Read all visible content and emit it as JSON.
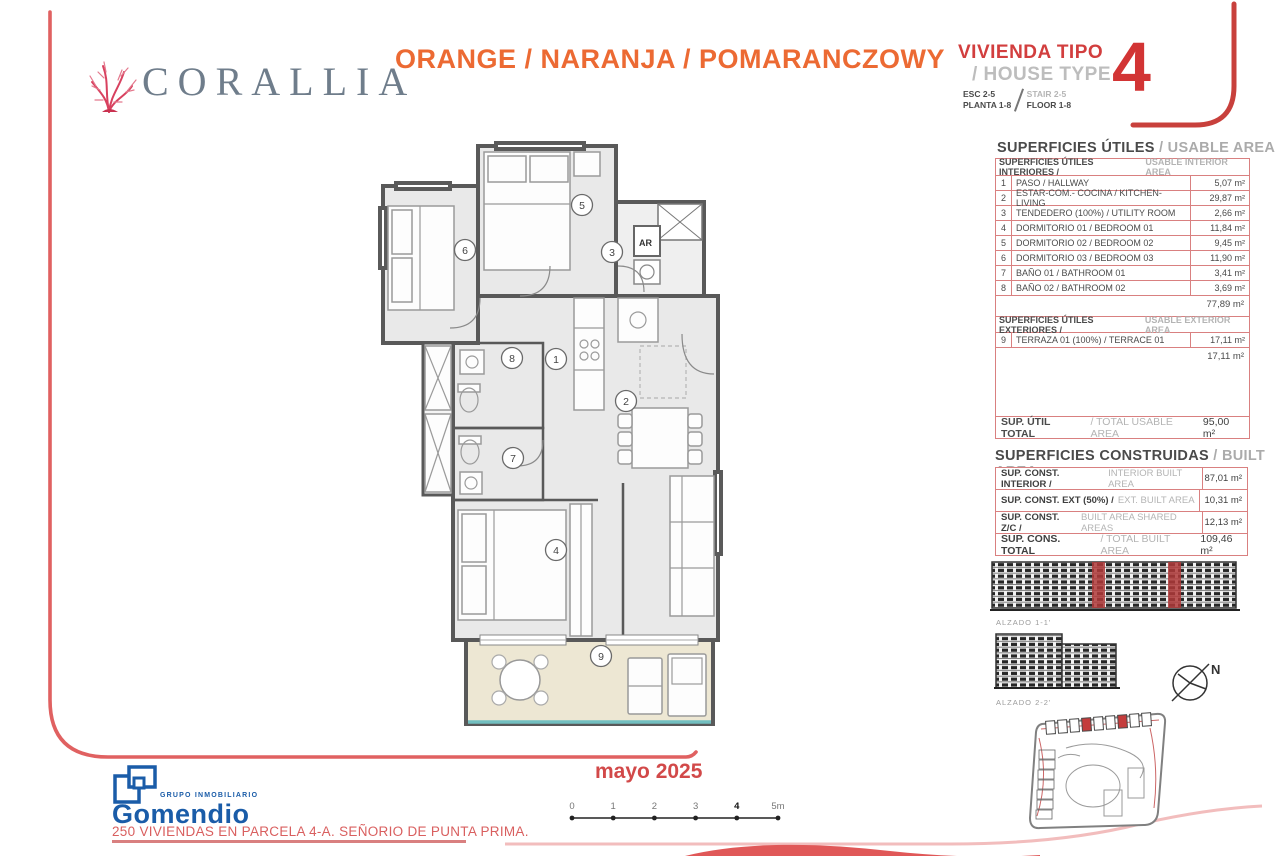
{
  "brand": {
    "name": "CORALLIA"
  },
  "header": {
    "color_title": "ORANGE / NARANJA / POMARANCZOWY"
  },
  "house_type": {
    "title_es": "VIVIENDA TIPO",
    "title_en": "/ HOUSE TYPE",
    "number": "4",
    "esc": "ESC 2-5",
    "planta": "PLANTA 1-8",
    "stair": "STAIR 2-5",
    "floor": "FLOOR 1-8"
  },
  "usable_area": {
    "title_es": "SUPERFICIES ÚTILES",
    "title_en": "/ USABLE AREA",
    "interior_header_es": "SUPERFICIES ÚTILES INTERIORES /",
    "interior_header_en": "USABLE INTERIOR AREA",
    "interior_rows": [
      {
        "num": "1",
        "label": "PASO / HALLWAY",
        "value": "5,07 m²"
      },
      {
        "num": "2",
        "label": "ESTAR-COM.- COCINA / KITCHEN-LIVING",
        "value": "29,87 m²"
      },
      {
        "num": "3",
        "label": "TENDEDERO (100%) / UTILITY ROOM",
        "value": "2,66 m²"
      },
      {
        "num": "4",
        "label": "DORMITORIO 01 / BEDROOM 01",
        "value": "11,84 m²"
      },
      {
        "num": "5",
        "label": "DORMITORIO 02 / BEDROOM 02",
        "value": "9,45 m²"
      },
      {
        "num": "6",
        "label": "DORMITORIO 03 / BEDROOM 03",
        "value": "11,90 m²"
      },
      {
        "num": "7",
        "label": "BAÑO 01 / BATHROOM 01",
        "value": "3,41 m²"
      },
      {
        "num": "8",
        "label": "BAÑO 02 / BATHROOM 02",
        "value": "3,69 m²"
      }
    ],
    "interior_subtotal": "77,89 m²",
    "exterior_header_es": "SUPERFICIES ÚTILES EXTERIORES /",
    "exterior_header_en": "USABLE EXTERIOR AREA",
    "exterior_rows": [
      {
        "num": "9",
        "label": "TERRAZA 01 (100%) / TERRACE 01",
        "value": "17,11 m²"
      }
    ],
    "exterior_subtotal": "17,11 m²",
    "total_es": "SUP. ÚTIL TOTAL",
    "total_en": "/ TOTAL USABLE AREA",
    "total_value": "95,00 m²"
  },
  "built_area": {
    "title_es": "SUPERFICIES CONSTRUIDAS",
    "title_en": "/ BUILT AREA",
    "rows": [
      {
        "label_es": "SUP. CONST. INTERIOR /",
        "label_en": "INTERIOR BUILT AREA",
        "value": "87,01 m²"
      },
      {
        "label_es": "SUP. CONST. EXT (50%) /",
        "label_en": "EXT. BUILT AREA",
        "value": "10,31 m²"
      },
      {
        "label_es": "SUP. CONST. Z/C /",
        "label_en": "BUILT AREA SHARED AREAS",
        "value": "12,13 m²"
      }
    ],
    "total_es": "SUP. CONS. TOTAL",
    "total_en": "/ TOTAL BUILT AREA",
    "total_value": "109,46 m²"
  },
  "drawings": {
    "alzado1_label": "ALZADO 1-1'",
    "alzado2_label": "ALZADO 2-2'",
    "north_label": "N"
  },
  "floor_plan": {
    "ar_label": "AR",
    "room_numbers": [
      "1",
      "2",
      "3",
      "4",
      "5",
      "6",
      "7",
      "8",
      "9"
    ]
  },
  "footer": {
    "date": "mayo 2025",
    "scale_ticks": [
      "0",
      "1",
      "2",
      "3",
      "4",
      "5m"
    ],
    "group_label": "GRUPO INMOBILIARIO",
    "developer": "Gomendio",
    "project_line": "250 VIVIENDAS EN PARCELA 4-A. SEÑORIO DE PUNTA PRIMA."
  },
  "colors": {
    "frame_red": "#E06161",
    "corner_red": "#C8403C",
    "table_border_red": "#D98080",
    "title_orange": "#EC6A33",
    "brand_gray": "#6F7D8B",
    "gomendio_blue": "#1A5CA8",
    "date_red": "#D24949",
    "terrace_beige": "#EDE7D3",
    "glass_teal": "#72BFC0",
    "elevation_highlight": "#B03A3A"
  }
}
